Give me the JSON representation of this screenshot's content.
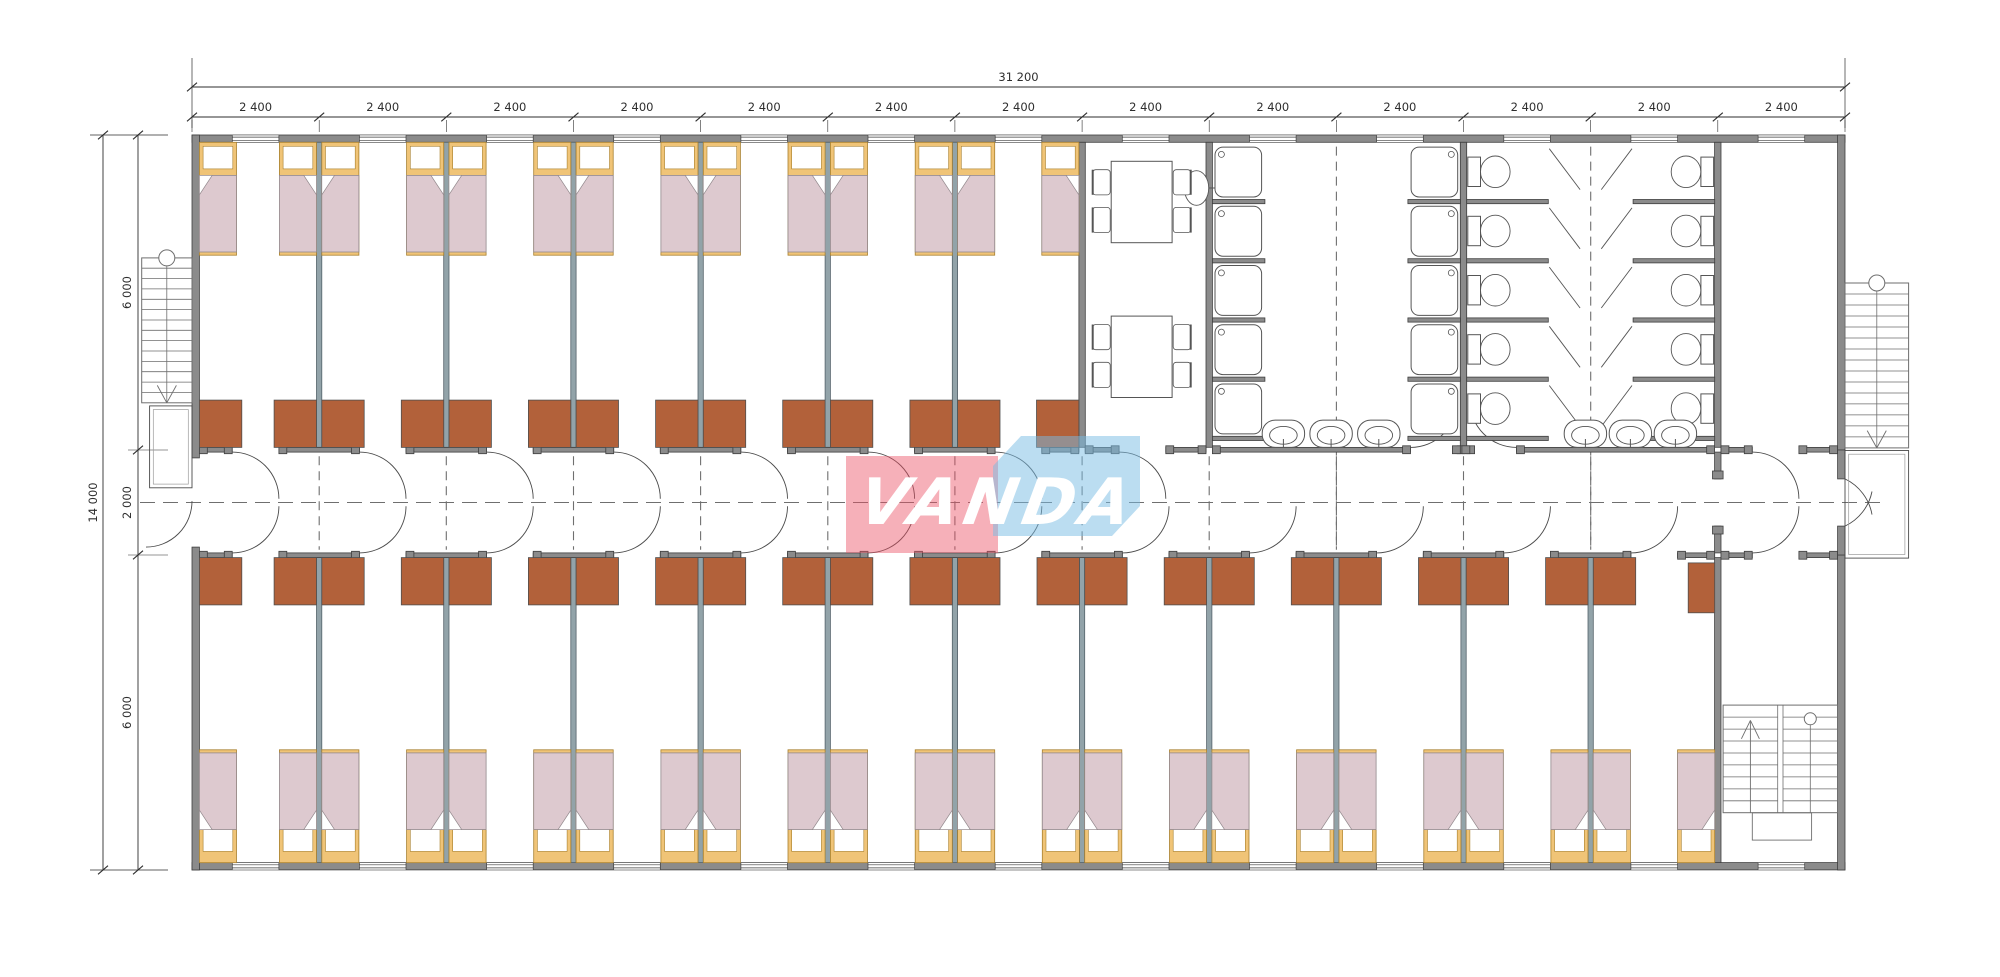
{
  "drawing": {
    "type": "modular-dormitory-floor-plan",
    "dimensions": {
      "top_total_label": "31 200",
      "module_label": "2 400",
      "module_count": 13,
      "left_total_label": "14 000",
      "left_segment_labels": [
        "6 000",
        "2 000",
        "6 000"
      ]
    },
    "logo": {
      "text": "VANDA",
      "red_block": "rgba(235,80,100,0.45)",
      "blue_block": "rgba(120,188,228,0.50)",
      "text_color": "#ffffff"
    },
    "colors": {
      "background": "#ffffff",
      "wall_fill": "#8b8b8b",
      "wall_stroke": "#3e3e3e",
      "partition_fill": "#92a3a9",
      "partition_stroke": "#54626a",
      "bed_frame": "#f0c477",
      "bed_frame_stroke": "#a8802e",
      "blanket": "#ddc9cf",
      "blanket_stroke": "#93898d",
      "pillow": "#ffffff",
      "wardrobe": "#b2613a",
      "wardrobe_stroke": "#4f4f4f",
      "fixture_stroke": "#555555",
      "fixture_fill": "#ffffff",
      "stair_stroke": "#6e6e6e",
      "dashed_line": "#6f6f6f",
      "dimension": "#2e2e2e"
    },
    "inventory": {
      "top_bedrooms": 7,
      "bottom_bedrooms": 12,
      "beds_per_room": 2,
      "wardrobes_per_room": 2,
      "dining_tables": 2,
      "chairs_per_table": 4,
      "shower_columns": 2,
      "showers_per_column": 5,
      "toilet_columns": 2,
      "toilets_per_column": 5,
      "wash_basins_per_room": 3,
      "dining_sinks": 1,
      "external_staircases": 2,
      "internal_staircases": 1
    }
  }
}
